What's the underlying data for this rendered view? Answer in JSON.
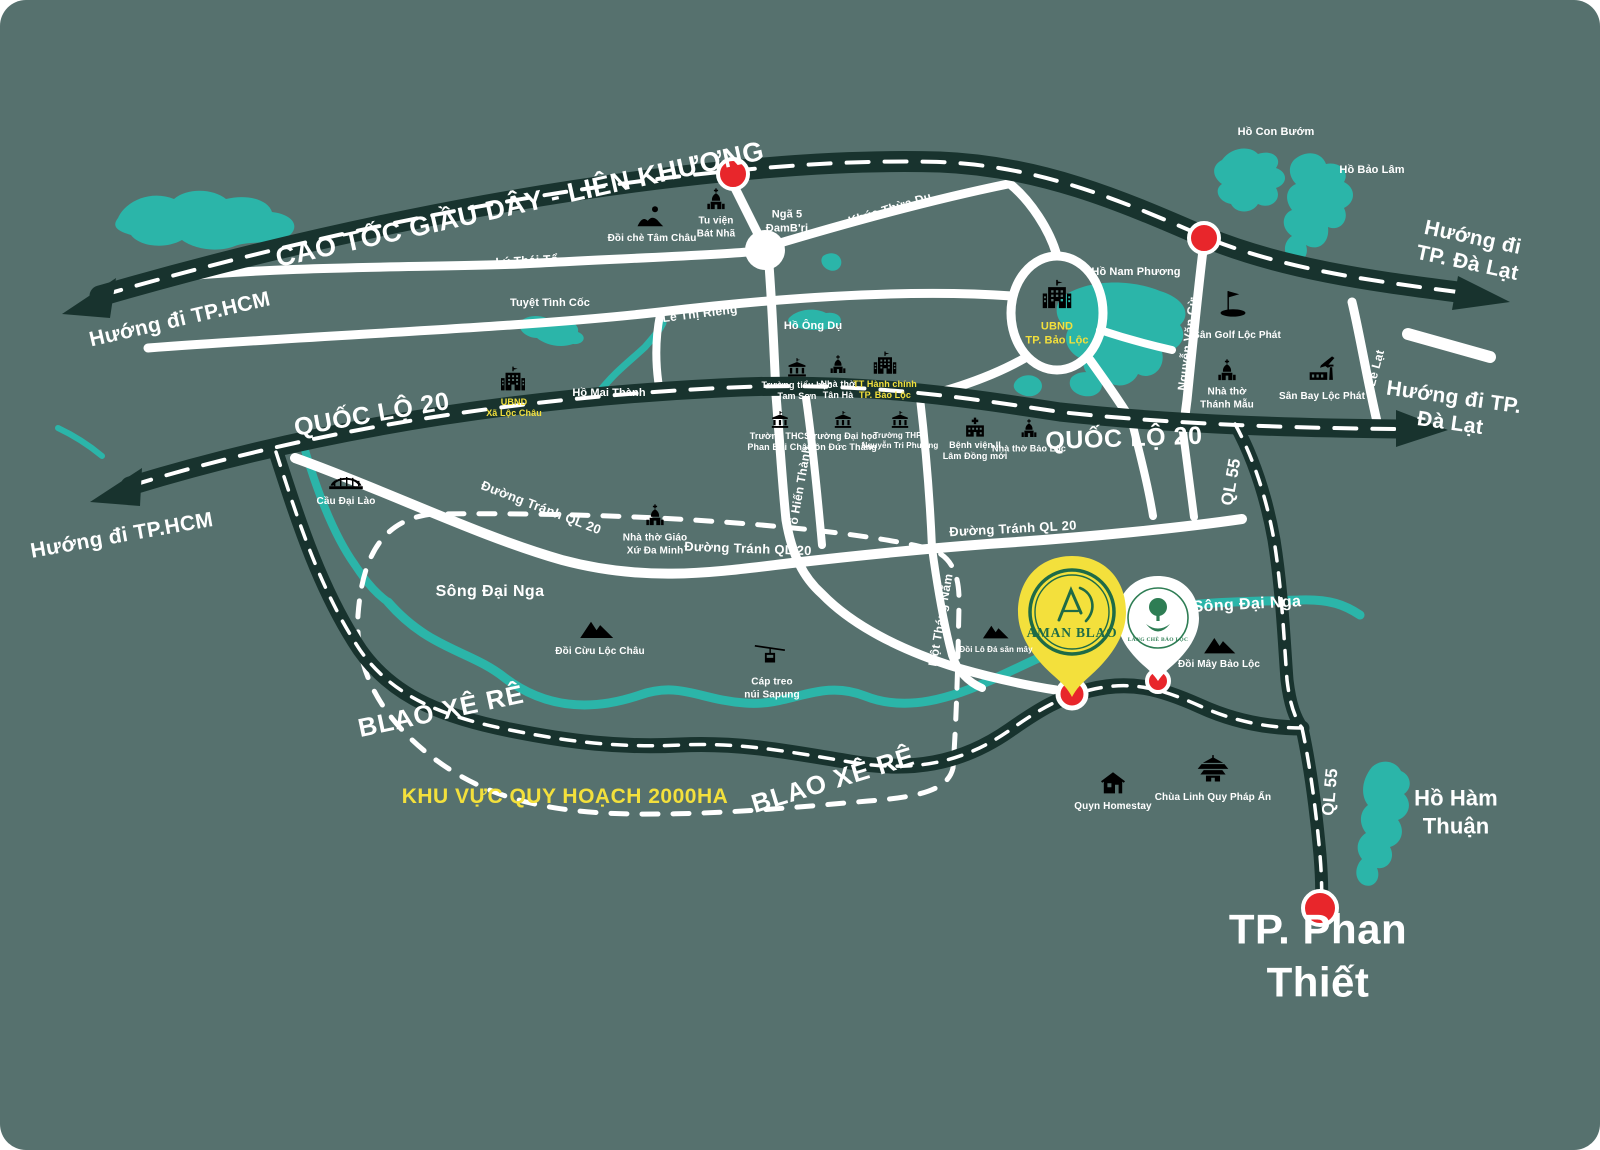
{
  "colors": {
    "background": "#56716e",
    "road_dark": "#18332e",
    "road_white": "#ffffff",
    "water_teal": "#2bb5a9",
    "accent_yellow": "#f3e03c",
    "marker_red": "#e8262b",
    "pin_green": "#1e6b47"
  },
  "highways": {
    "cao_toc": "CAO TỐC GIẦU DÂY - LIÊN KHƯƠNG",
    "ql20_a": "QUỐC LỘ 20",
    "ql20_b": "QUỐC LỘ 20",
    "ql55_a": "QL 55",
    "ql55_b": "QL 55",
    "blao_a": "BLAO XÊ RÊ",
    "blao_b": "BLAO XÊ RÊ"
  },
  "directions": {
    "hcm_a": "Hướng đi TP.HCM",
    "hcm_b": "Hướng đi TP.HCM",
    "dalat_a": "Hướng đi TP. Đà Lạt",
    "dalat_b": "Hướng đi TP. Đà Lạt",
    "phan_thiet": "TP. Phan Thiết"
  },
  "streets": {
    "ly_thai_to": "Lý Thái Tổ",
    "khuc_thua_du": "Khúc Thừa Dụ",
    "le_thi_rieng": "Lê Thị Riêng",
    "nga_5": "Ngã 5\nĐamB'ri",
    "nguyen_van_cu": "Nguyễn Văn Cừ",
    "le_lat": "Lê Lạt",
    "to_hien_thanh": "Tô Hiến Thành",
    "mot_thang_nam": "Một Tháng Năm",
    "duong_tranh_a": "Đường Tránh QL 20",
    "duong_tranh_b": "Đường Tránh QL 20",
    "duong_tranh_c": "Đường Tránh QL 20"
  },
  "waters": {
    "ho_con_buom": "Hồ Con Bướm",
    "ho_bao_lam": "Hồ Bảo Lâm",
    "ho_nam_phuong": "Hồ Nam Phương",
    "tuyet_tinh_coc": "Tuyệt Tình Cốc",
    "ho_ong_du": "Hồ Ông Dụ",
    "ho_mai_thanh": "Hồ Mai Thành",
    "song_dai_nga_a": "Sông Đại Nga",
    "song_dai_nga_b": "Sông Đại Nga",
    "ho_ham_thuan": "Hồ Hàm Thuận"
  },
  "pois": {
    "doi_che_tam_chau": "Đồi chè Tâm Châu",
    "tu_vien_bat_nha": "Tu viện\nBát Nhã",
    "ubnd_tp_bao_loc": "UBND\nTP. Bảo Lộc",
    "san_golf_loc_phat": "Sân Golf Lộc Phát",
    "nha_tho_thanh_mau": "Nhà thờ\nThánh Mẫu",
    "san_bay_loc_phat": "Sân Bay Lộc Phát",
    "ubnd_xa_loc_chau": "UBND\nXã Lộc Châu",
    "truong_th_tam_son": "Trường tiểu học\nTam Sơn",
    "nha_tho_tan_ha": "Nhà thờ\nTân Hà",
    "tt_hanh_chinh": "TT Hành chính\nTP. Bảo Lộc",
    "truong_thcs_pbc": "Trường THCS\nPhan Bội Châu",
    "truong_dh_tdt": "Trường Đại học\nTôn Đức Thắng",
    "truong_thpt_ntp": "Trường THPT\nNguyễn Tri Phương",
    "benh_vien": "Bệnh viện II\nLâm Đồng mới",
    "nha_tho_bao_loc": "Nhà thờ Bảo Lộc",
    "cau_dai_lao": "Cầu Đại Lào",
    "nha_tho_da_minh": "Nhà thờ Giáo\nXứ Đa Minh",
    "doi_cuu_loc_chau": "Đồi Cừu Lộc Châu",
    "cap_treo_sapung": "Cáp treo\nnúi Sapung",
    "doi_lo_da": "Đồi Lô Đá săn mây",
    "doi_may_bao_loc": "Đồi Mây Bảo Lộc",
    "quyn_homestay": "Quyn Homestay",
    "chua_linh_quy": "Chùa Linh Quy Pháp Ấn"
  },
  "pins": {
    "aman_blao": "AMAN BLAO",
    "lang_che_bao_loc": "LÀNG CHÈ BẢO LỘC"
  },
  "areas": {
    "planning": "KHU VỰC QUY HOẠCH 2000HA"
  }
}
